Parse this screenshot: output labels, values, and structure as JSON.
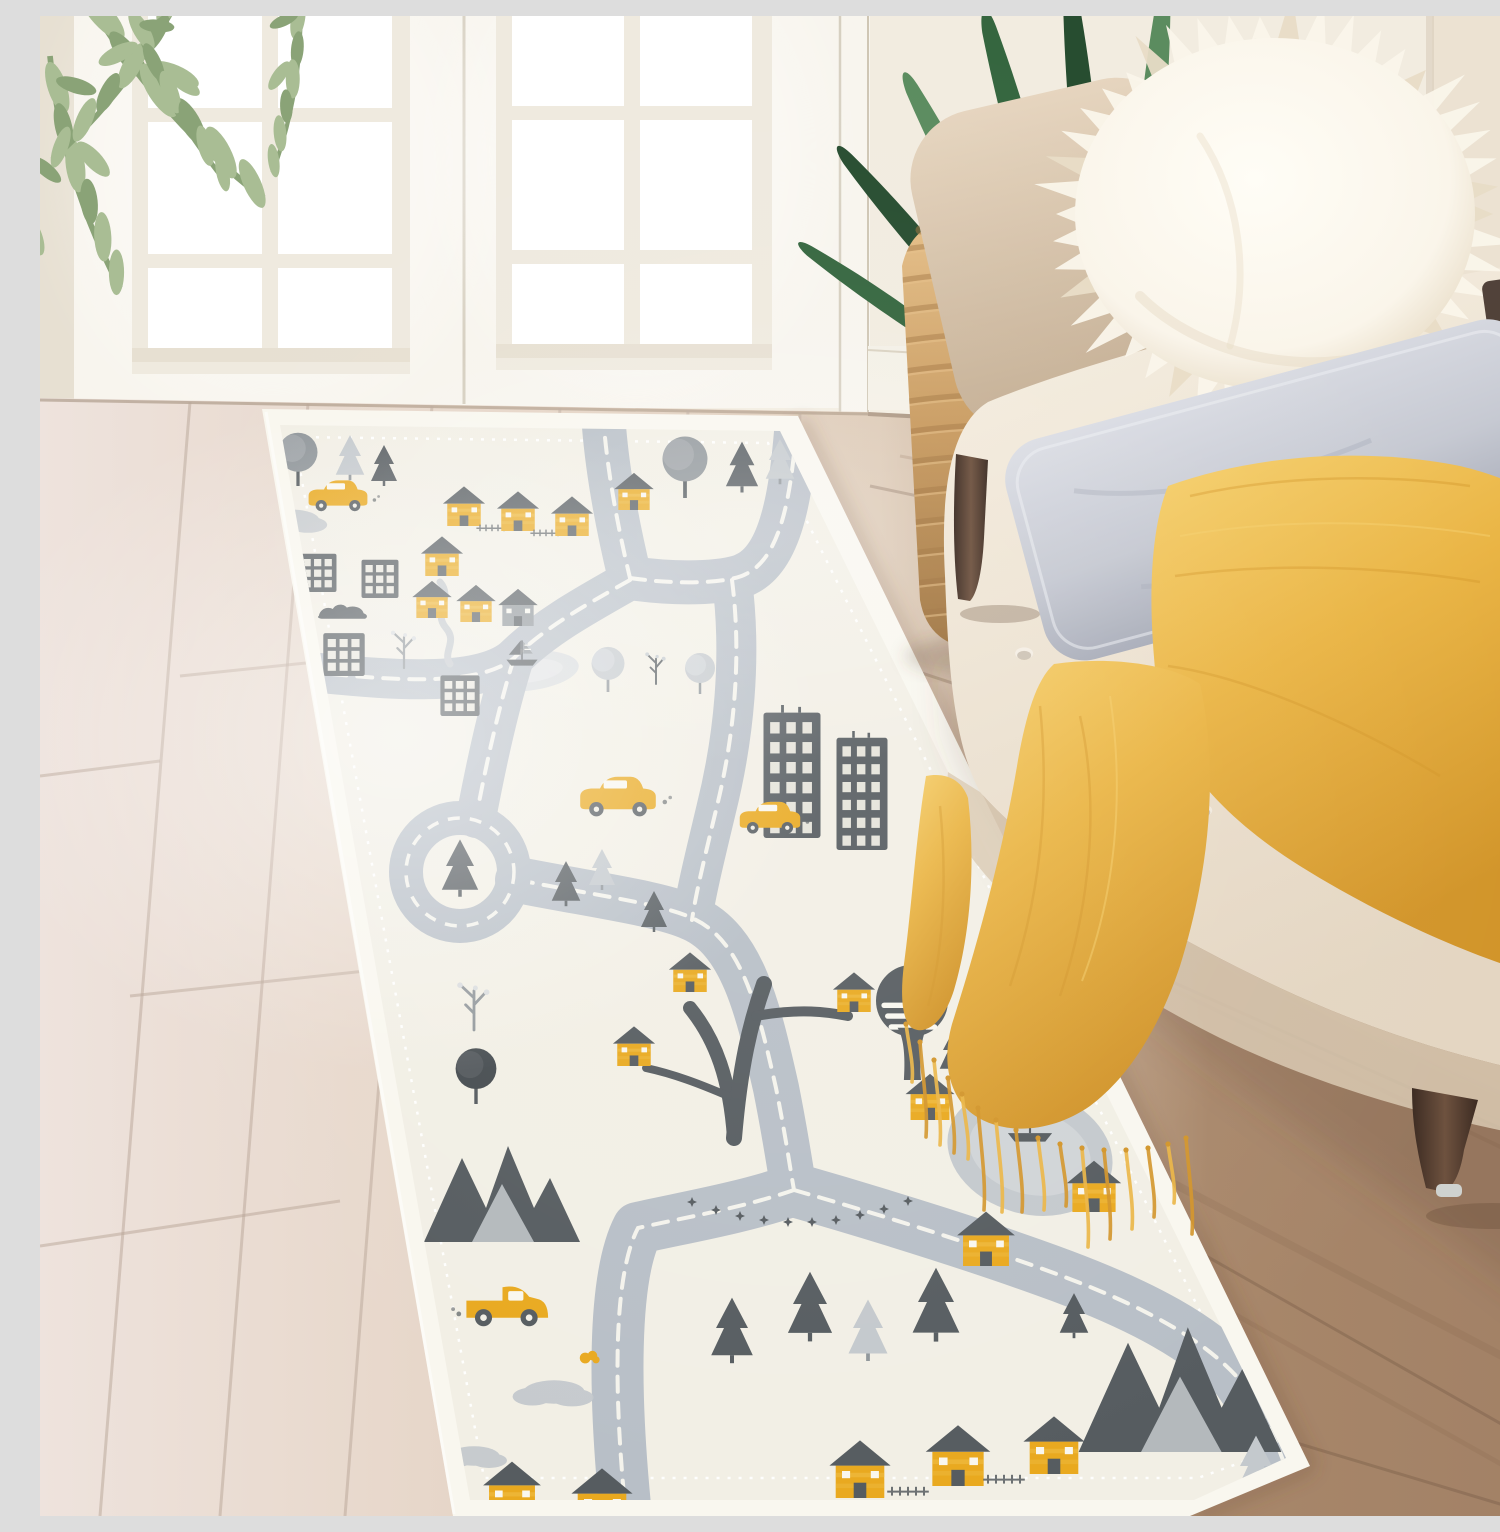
{
  "scene": {
    "caption": "Bright entryway: a cream kids' play rug runner printed with gray roads, charcoal buildings, trees, mountains and mustard-yellow houses and cars, laid diagonally on a wooden floor in front of white French doors, beside a cream button-tufted bench with a white fur pillow, a gray velvet pillow, a mustard fringed throw blanket, a woven rattan basket and green plants."
  },
  "objects": {
    "rug": "city road-map play rug runner",
    "french_doors": "white French doors with divided glass panes",
    "bench": "cream button-tufted upholstered bench with dark espresso legs",
    "fur_pillow": "white faux-fur pillow",
    "velvet_pillow": "light gray velvet lumbar pillow",
    "throw_blanket": "mustard yellow fringed throw blanket",
    "basket": "woven rattan basket",
    "plant_left": "trailing sage-green plant sprig",
    "plant_right": "dracaena plant with long green leaves",
    "floor": "diagonal wood plank floor, whitewashed at left, warm brown at right"
  },
  "palette": {
    "wall": "#f2ece0",
    "wallRight": "#ece2d2",
    "door": "#f8f5ee",
    "doorShade": "#e7e0d2",
    "doorDark": "#d6cfc0",
    "glass": "#ffffff",
    "floorLeft": "#eee3dd",
    "floorMid": "#dbc7b2",
    "floorRight": "#a8876a",
    "floorDeep": "#8d6d53",
    "seam": "#b9a698",
    "seamRight": "#6e5440",
    "rugBase": "#f2efe5",
    "rugBorder": "#f9f7ef",
    "road": "#b8bfc7",
    "dash": "#f4f3ec",
    "ink": "#565c60",
    "inkDeep": "#474d51",
    "gray": "#90969a",
    "grayLight": "#c4c9cd",
    "grayPale": "#d9dcde",
    "yellow": "#e9a91f",
    "yellowLight": "#f2c14b",
    "yellowDeep": "#c98a12",
    "benchBeige": "#d8c5ae",
    "benchBeigeDark": "#c2ac91",
    "seatCream": "#f1e9db",
    "seatShadow": "#d9c9b2",
    "legWood": "#4a352b",
    "legWoodLight": "#6e523f",
    "basket": "#c89a5f",
    "basketDark": "#9f7440",
    "basketLight": "#e6c089",
    "blanket": "#eab545",
    "blanketDeep": "#d2952a",
    "blanketLight": "#f6d06e",
    "furLight": "#faf5ea",
    "furShade": "#e8dcc6",
    "pillowGray": "#c6c9d2",
    "pillowGrayDark": "#a8acb8",
    "pillowGrayLight": "#dcdee5",
    "green": "#35663f",
    "greenDark": "#274d30",
    "greenLight": "#5b8c5f",
    "sage": "#a9bd94",
    "sageDark": "#8aa377"
  },
  "rug": {
    "roads": [
      {
        "d": "M563,396 C566,450 578,512 590,562",
        "w": 44
      },
      {
        "d": "M590,562 C646,570 692,566 706,558 C744,540 752,468 757,404",
        "w": 44
      },
      {
        "d": "M590,564 C544,590 504,612 474,642 C436,674 334,662 270,656",
        "w": 40
      },
      {
        "d": "M474,642 C456,700 444,760 436,802",
        "w": 40
      },
      {
        "d": "M692,564 C702,642 694,722 676,794 C666,836 656,876 652,904",
        "w": 40
      },
      {
        "d": "M478,864 C560,880 622,888 652,902 C702,924 718,992 736,1072 C746,1122 750,1152 754,1174",
        "w": 46
      },
      {
        "d": "M754,1174 C702,1192 642,1202 598,1212 C572,1262 574,1382 586,1500",
        "w": 52
      },
      {
        "d": "M754,1174 C852,1202 952,1234 1022,1260 C1102,1290 1162,1322 1198,1362 C1224,1398 1240,1432 1246,1454",
        "w": 54
      }
    ],
    "motifs": [
      [
        "treeRound",
        258,
        470,
        0.65
      ],
      [
        "pineL",
        310,
        462,
        0.55
      ],
      [
        "carY",
        298,
        484,
        0.7
      ],
      [
        "pineD",
        344,
        468,
        0.5
      ],
      [
        "treeRound",
        645,
        482,
        0.75
      ],
      [
        "pineD",
        702,
        474,
        0.62
      ],
      [
        "pineL",
        740,
        466,
        0.55
      ],
      [
        "treeBranch",
        784,
        478,
        0.6
      ],
      [
        "cloudSun",
        252,
        504,
        0.8
      ],
      [
        "houseY",
        424,
        510,
        0.62
      ],
      [
        "fence",
        452,
        514,
        0.6
      ],
      [
        "houseY",
        478,
        515,
        0.62
      ],
      [
        "fence",
        506,
        519,
        0.6
      ],
      [
        "houseY",
        532,
        520,
        0.62
      ],
      [
        "houseY",
        594,
        494,
        0.58
      ],
      [
        "building",
        278,
        576,
        0.66
      ],
      [
        "building",
        340,
        582,
        0.66
      ],
      [
        "houseY",
        402,
        560,
        0.62
      ],
      [
        "houseY",
        392,
        602,
        0.58
      ],
      [
        "houseY",
        436,
        606,
        0.58
      ],
      [
        "houseG",
        478,
        610,
        0.58
      ],
      [
        "bushD",
        304,
        600,
        0.7
      ],
      [
        "building",
        304,
        660,
        0.74
      ],
      [
        "treeBranchL",
        364,
        652,
        0.55
      ],
      [
        "building",
        420,
        700,
        0.7
      ],
      [
        "boat",
        482,
        640,
        0.6
      ],
      [
        "treeRoundL",
        568,
        676,
        0.55
      ],
      [
        "treeBranch",
        616,
        668,
        0.55
      ],
      [
        "treeRoundL",
        660,
        678,
        0.5
      ],
      [
        "buildingTall",
        752,
        822,
        0.95
      ],
      [
        "buildingTall",
        822,
        834,
        0.85
      ],
      [
        "carY",
        578,
        786,
        0.9
      ],
      [
        "carY",
        730,
        806,
        0.72
      ],
      [
        "pineD",
        526,
        888,
        0.55
      ],
      [
        "pineL",
        562,
        872,
        0.5
      ],
      [
        "pineD",
        614,
        914,
        0.5
      ],
      [
        "treeBranchL",
        434,
        1014,
        0.7
      ],
      [
        "treeRoundD",
        436,
        1088,
        0.68
      ],
      [
        "houseY",
        650,
        976,
        0.62
      ],
      [
        "houseY",
        594,
        1050,
        0.62
      ],
      [
        "houseY",
        814,
        996,
        0.62
      ],
      [
        "platformTree",
        872,
        1064,
        0.9
      ],
      [
        "starsArc",
        762,
        1184,
        1
      ],
      [
        "houseY",
        890,
        1104,
        0.72
      ],
      [
        "pineD",
        914,
        1056,
        0.55
      ],
      [
        "pineL",
        950,
        1032,
        0.5
      ],
      [
        "mtn",
        462,
        1226,
        1.0
      ],
      [
        "truckY",
        472,
        1296,
        0.95
      ],
      [
        "cloud",
        514,
        1376,
        0.9
      ],
      [
        "cloudY",
        550,
        1342,
        0.6
      ],
      [
        "cloud",
        434,
        1440,
        0.75
      ],
      [
        "houseY",
        472,
        1500,
        0.85
      ],
      [
        "houseY",
        562,
        1510,
        0.9
      ],
      [
        "pineD",
        692,
        1344,
        0.8
      ],
      [
        "pineD",
        770,
        1322,
        0.85
      ],
      [
        "pineL",
        828,
        1342,
        0.75
      ],
      [
        "pineD",
        896,
        1322,
        0.9
      ],
      [
        "houseY",
        820,
        1482,
        0.9
      ],
      [
        "fence",
        868,
        1478,
        0.8
      ],
      [
        "houseY",
        918,
        1470,
        0.95
      ],
      [
        "fence",
        964,
        1466,
        0.8
      ],
      [
        "houseY",
        1014,
        1458,
        0.9
      ],
      [
        "boat",
        990,
        1112,
        0.85
      ],
      [
        "houseY",
        1054,
        1196,
        0.8
      ],
      [
        "houseY",
        946,
        1250,
        0.85
      ],
      [
        "mtn",
        1140,
        1436,
        1.3
      ],
      [
        "pineL",
        1216,
        1482,
        0.8
      ],
      [
        "pineD",
        1034,
        1320,
        0.55
      ]
    ]
  },
  "floor": {
    "seams_left": [
      [
        150,
        386,
        60,
        1500
      ],
      [
        268,
        388,
        180,
        1500
      ],
      [
        392,
        390,
        305,
        1500
      ],
      [
        520,
        392,
        448,
        1500
      ],
      [
        648,
        394,
        600,
        1500
      ],
      [
        760,
        396,
        730,
        1500
      ]
    ],
    "joints_left": [
      [
        0,
        1230,
        300,
        1185
      ],
      [
        90,
        980,
        420,
        945
      ],
      [
        140,
        660,
        430,
        630
      ],
      [
        0,
        760,
        120,
        745
      ]
    ],
    "seams_right": [
      [
        830,
        470,
        1500,
        610
      ],
      [
        830,
        640,
        1500,
        860
      ],
      [
        828,
        830,
        1500,
        1130
      ],
      [
        850,
        1060,
        1500,
        1430
      ],
      [
        900,
        1320,
        1500,
        1500
      ]
    ],
    "streaks": [
      [
        960,
        560,
        1500,
        700,
        5
      ],
      [
        1000,
        760,
        1500,
        930,
        7
      ],
      [
        980,
        900,
        1500,
        1150,
        4
      ],
      [
        1100,
        1150,
        1500,
        1360,
        8
      ],
      [
        1180,
        1290,
        1500,
        1470,
        5
      ],
      [
        860,
        440,
        1500,
        560,
        3
      ]
    ]
  },
  "bench": {
    "tufting": {
      "quad": [
        [
          952,
          418
        ],
        [
          1488,
          272
        ],
        [
          1488,
          1012
        ],
        [
          946,
          752
        ]
      ],
      "rows": 4,
      "cols": 7
    }
  },
  "pillows": {
    "fur": {
      "cx": 1235,
      "cy": 198,
      "rx": 200,
      "ry": 176,
      "n": 46
    }
  },
  "blanket": {
    "fringe": {
      "bases": [
        [
          866,
          1008
        ],
        [
          880,
          1026
        ],
        [
          894,
          1044
        ],
        [
          908,
          1062
        ],
        [
          922,
          1078
        ],
        [
          938,
          1092
        ],
        [
          956,
          1104
        ],
        [
          976,
          1114
        ],
        [
          998,
          1122
        ],
        [
          1020,
          1128
        ],
        [
          1042,
          1132
        ],
        [
          1064,
          1134
        ],
        [
          1086,
          1134
        ],
        [
          1108,
          1132
        ],
        [
          1128,
          1128
        ],
        [
          1146,
          1122
        ]
      ]
    }
  },
  "basket": {
    "rows": 13,
    "y0": 234,
    "dy": 30.5
  },
  "plants": {
    "dracaena": [
      [
        960,
        366,
        -55,
        0.8
      ],
      [
        986,
        352,
        -40,
        0.95
      ],
      [
        1012,
        342,
        -27,
        1.05
      ],
      [
        1038,
        334,
        -15,
        1.15
      ],
      [
        1064,
        330,
        -5,
        1.2
      ],
      [
        1090,
        332,
        6,
        1.18
      ],
      [
        1116,
        338,
        18,
        1.08
      ],
      [
        1142,
        348,
        31,
        0.95
      ],
      [
        1164,
        360,
        44,
        0.85
      ],
      [
        1184,
        374,
        57,
        0.7
      ],
      [
        1048,
        336,
        -10,
        0.75
      ],
      [
        1082,
        334,
        2,
        0.78
      ]
    ],
    "eucalyptus": [
      [
        40,
        -30,
        8,
        2.2,
        1
      ],
      [
        10,
        40,
        32,
        1.9,
        1
      ],
      [
        -5,
        120,
        55,
        1.7,
        1
      ],
      [
        -10,
        230,
        74,
        1.5,
        1
      ],
      [
        -8,
        330,
        84,
        1.25,
        1
      ],
      [
        150,
        -40,
        -12,
        1.8,
        -1
      ],
      [
        260,
        -20,
        -40,
        1.4,
        -1
      ],
      [
        90,
        -10,
        20,
        1.6,
        1
      ]
    ]
  }
}
